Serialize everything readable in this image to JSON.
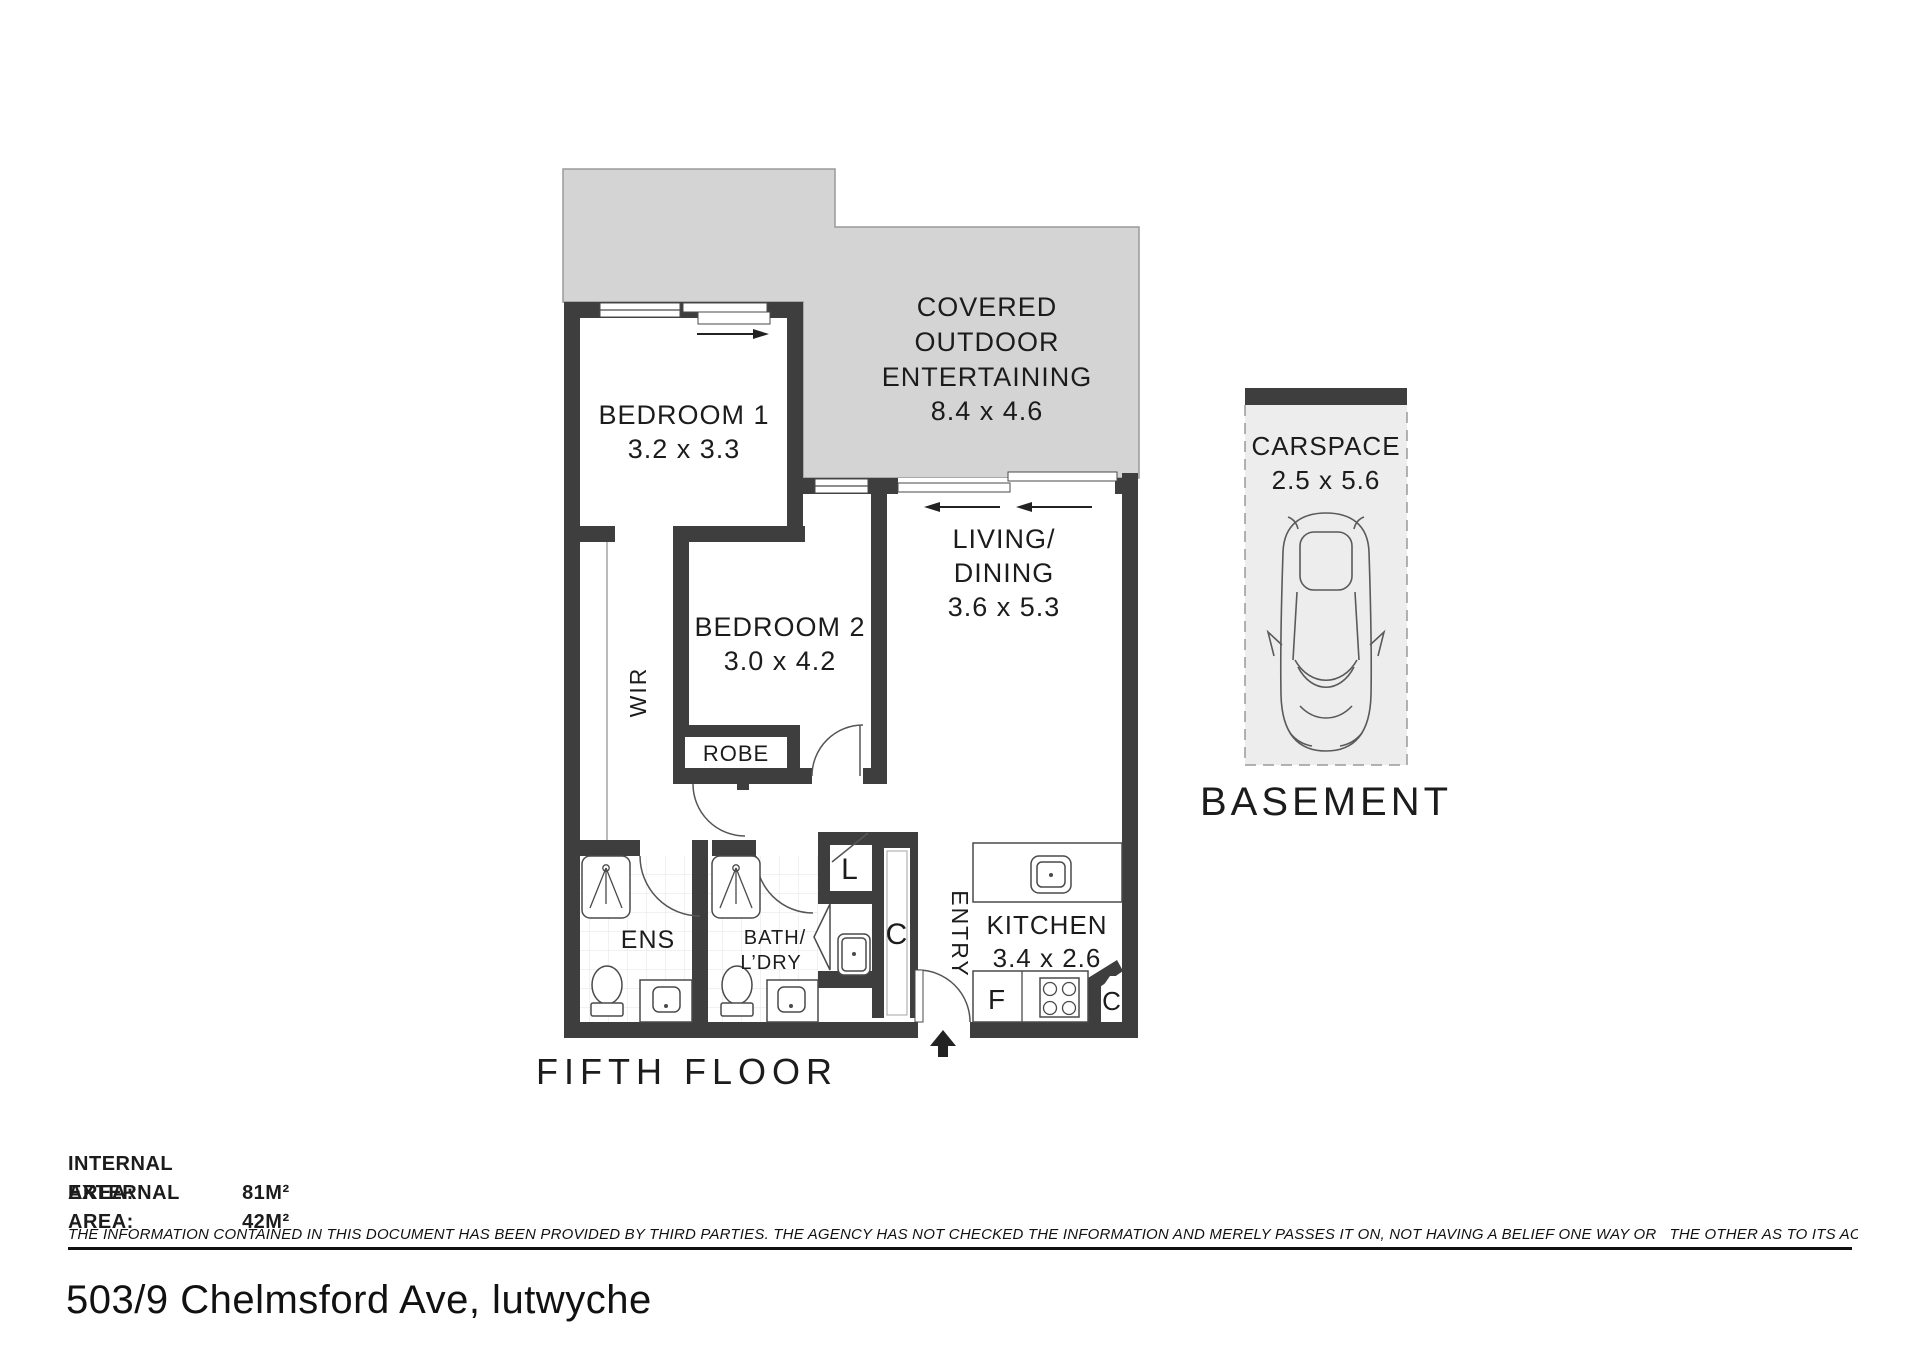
{
  "plan": {
    "floor_label": "FIFTH FLOOR",
    "outdoor": {
      "line1": "COVERED",
      "line2": "OUTDOOR",
      "line3": "ENTERTAINING",
      "dims": "8.4 x 4.6"
    },
    "bedroom1": {
      "name": "BEDROOM 1",
      "dims": "3.2 x 3.3"
    },
    "bedroom2": {
      "name": "BEDROOM 2",
      "dims": "3.0 x 4.2"
    },
    "living": {
      "line1": "LIVING/",
      "line2": "DINING",
      "dims": "3.6 x 5.3"
    },
    "kitchen": {
      "name": "KITCHEN",
      "dims": "3.4 x 2.6"
    },
    "wir": "WIR",
    "robe": "ROBE",
    "ens": "ENS",
    "bath_line1": "BATH/",
    "bath_line2": "L’DRY",
    "linen": "L",
    "hall_cupboard": "C",
    "entry": "ENTRY",
    "fridge": "F",
    "kitchen_cupboard": "C"
  },
  "carspace": {
    "name": "CARSPACE",
    "dims": "2.5 x 5.6",
    "location": "BASEMENT"
  },
  "areas": {
    "internal_label": "INTERNAL AREA:",
    "internal_value": "81M²",
    "external_label": "EXTERNAL AREA:",
    "external_value": "42M²"
  },
  "disclaimer": "THE INFORMATION CONTAINED IN THIS DOCUMENT HAS BEEN PROVIDED BY THIRD PARTIES. THE AGENCY HAS NOT CHECKED THE INFORMATION AND MERELY PASSES IT ON, NOT HAVING A BELIEF ONE WAY OR   THE OTHER AS TO ITS ACCURACY   INTERESTED PARTIES SHOULD MAKE AND RELY UPON THEIR OWN ENQUIRIES.",
  "address": "503/9 Chelmsford Ave, lutwyche",
  "colors": {
    "wall": "#3E3E3E",
    "balcony": "#D4D4D4",
    "carspace_fill": "#EDEDED",
    "text": "#1C1C1C"
  }
}
